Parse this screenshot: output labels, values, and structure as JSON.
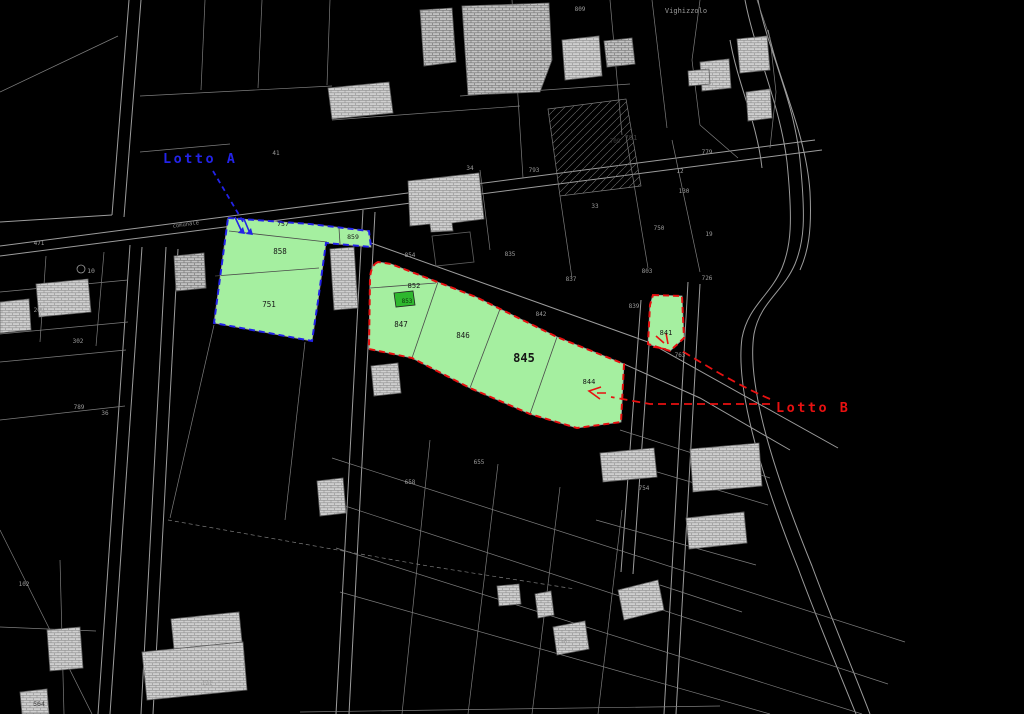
{
  "map": {
    "background": "#000000",
    "lots": {
      "lotto_a": {
        "label": "Lotto A",
        "accent": "#2323e8",
        "fill": "#a5efa0",
        "parcels": [
          "757",
          "858",
          "751",
          "859"
        ]
      },
      "lotto_b": {
        "label": "Lotto B",
        "accent": "#e81111",
        "fill": "#a5efa0",
        "highlight_fill": "#2eb82e",
        "parcels": [
          "852",
          "853",
          "847",
          "846",
          "845",
          "844",
          "841"
        ]
      }
    },
    "labels": [
      {
        "text": "757",
        "x": 283,
        "y": 226,
        "size": 6.5,
        "color": "#161616"
      },
      {
        "text": "859",
        "x": 353,
        "y": 239,
        "size": 6.5,
        "color": "#161616"
      },
      {
        "text": "858",
        "x": 280,
        "y": 254,
        "size": 7.5,
        "color": "#161616"
      },
      {
        "text": "751",
        "x": 269,
        "y": 307,
        "size": 7.5,
        "color": "#161616"
      },
      {
        "text": "852",
        "x": 414,
        "y": 288,
        "size": 7,
        "color": "#161616"
      },
      {
        "text": "853",
        "x": 407,
        "y": 303,
        "size": 6,
        "color": "#0d330d"
      },
      {
        "text": "847",
        "x": 401,
        "y": 327,
        "size": 7.5,
        "color": "#161616"
      },
      {
        "text": "846",
        "x": 463,
        "y": 338,
        "size": 7.5,
        "color": "#161616"
      },
      {
        "text": "845",
        "x": 524,
        "y": 362,
        "size": 12,
        "color": "#161616",
        "bold": true
      },
      {
        "text": "844",
        "x": 589,
        "y": 384,
        "size": 7,
        "color": "#161616"
      },
      {
        "text": "841",
        "x": 666,
        "y": 335,
        "size": 7,
        "color": "#161616"
      },
      {
        "text": "Vighizzolo",
        "x": 686,
        "y": 13,
        "size": 7,
        "color": "#9b9b9b"
      },
      {
        "text": "comunale",
        "x": 186,
        "y": 226,
        "size": 5.5,
        "color": "#8a8a8a",
        "rotate": -8
      },
      {
        "text": "41",
        "x": 276,
        "y": 155,
        "size": 6,
        "color": "#9b9b9b"
      },
      {
        "text": "34",
        "x": 470,
        "y": 170,
        "size": 6,
        "color": "#9b9b9b"
      },
      {
        "text": "793",
        "x": 534,
        "y": 172,
        "size": 6,
        "color": "#9b9b9b"
      },
      {
        "text": "809",
        "x": 580,
        "y": 11,
        "size": 6,
        "color": "#9b9b9b"
      },
      {
        "text": "791",
        "x": 631,
        "y": 140,
        "size": 7,
        "color": "#3c3c3c"
      },
      {
        "text": "709",
        "x": 615,
        "y": 143,
        "size": 6,
        "color": "#3c3c3c"
      },
      {
        "text": "779",
        "x": 707,
        "y": 154,
        "size": 6,
        "color": "#9b9b9b"
      },
      {
        "text": "12",
        "x": 680,
        "y": 173,
        "size": 6,
        "color": "#9b9b9b"
      },
      {
        "text": "130",
        "x": 684,
        "y": 193,
        "size": 6,
        "color": "#9b9b9b"
      },
      {
        "text": "750",
        "x": 659,
        "y": 230,
        "size": 6,
        "color": "#9b9b9b"
      },
      {
        "text": "33",
        "x": 595,
        "y": 208,
        "size": 6,
        "color": "#9b9b9b"
      },
      {
        "text": "19",
        "x": 709,
        "y": 236,
        "size": 6,
        "color": "#9b9b9b"
      },
      {
        "text": "854",
        "x": 410,
        "y": 257,
        "size": 6,
        "color": "#9b9b9b"
      },
      {
        "text": "835",
        "x": 510,
        "y": 256,
        "size": 6,
        "color": "#9b9b9b"
      },
      {
        "text": "837",
        "x": 571,
        "y": 281,
        "size": 6,
        "color": "#9b9b9b"
      },
      {
        "text": "803",
        "x": 647,
        "y": 273,
        "size": 6,
        "color": "#9b9b9b"
      },
      {
        "text": "842",
        "x": 541,
        "y": 316,
        "size": 6,
        "color": "#9b9b9b"
      },
      {
        "text": "839",
        "x": 634,
        "y": 308,
        "size": 6,
        "color": "#9b9b9b"
      },
      {
        "text": "726",
        "x": 707,
        "y": 280,
        "size": 6,
        "color": "#9b9b9b"
      },
      {
        "text": "763",
        "x": 680,
        "y": 357,
        "size": 6,
        "color": "#9b9b9b"
      },
      {
        "text": "754",
        "x": 644,
        "y": 490,
        "size": 6,
        "color": "#9b9b9b"
      },
      {
        "text": "655",
        "x": 479,
        "y": 464,
        "size": 6,
        "color": "#9b9b9b"
      },
      {
        "text": "658",
        "x": 410,
        "y": 484,
        "size": 6,
        "color": "#9b9b9b"
      },
      {
        "text": "758",
        "x": 562,
        "y": 643,
        "size": 6,
        "color": "#9b9b9b"
      },
      {
        "text": "102",
        "x": 24,
        "y": 586,
        "size": 6,
        "color": "#9b9b9b"
      },
      {
        "text": "789",
        "x": 79,
        "y": 409,
        "size": 6,
        "color": "#9b9b9b"
      },
      {
        "text": "36",
        "x": 105,
        "y": 415,
        "size": 6,
        "color": "#9b9b9b"
      },
      {
        "text": "471",
        "x": 39,
        "y": 245,
        "size": 6,
        "color": "#9b9b9b"
      },
      {
        "text": "10",
        "x": 91,
        "y": 273,
        "size": 6.5,
        "color": "#9b9b9b"
      },
      {
        "text": "209",
        "x": 39,
        "y": 312,
        "size": 6,
        "color": "#9b9b9b"
      },
      {
        "text": "302",
        "x": 78,
        "y": 343,
        "size": 6,
        "color": "#9b9b9b"
      },
      {
        "text": "564",
        "x": 39,
        "y": 706,
        "size": 6.5,
        "color": "#3c3c3c"
      },
      {
        "text": "121",
        "x": 207,
        "y": 685,
        "size": 6,
        "color": "#9b9b9b"
      }
    ]
  }
}
